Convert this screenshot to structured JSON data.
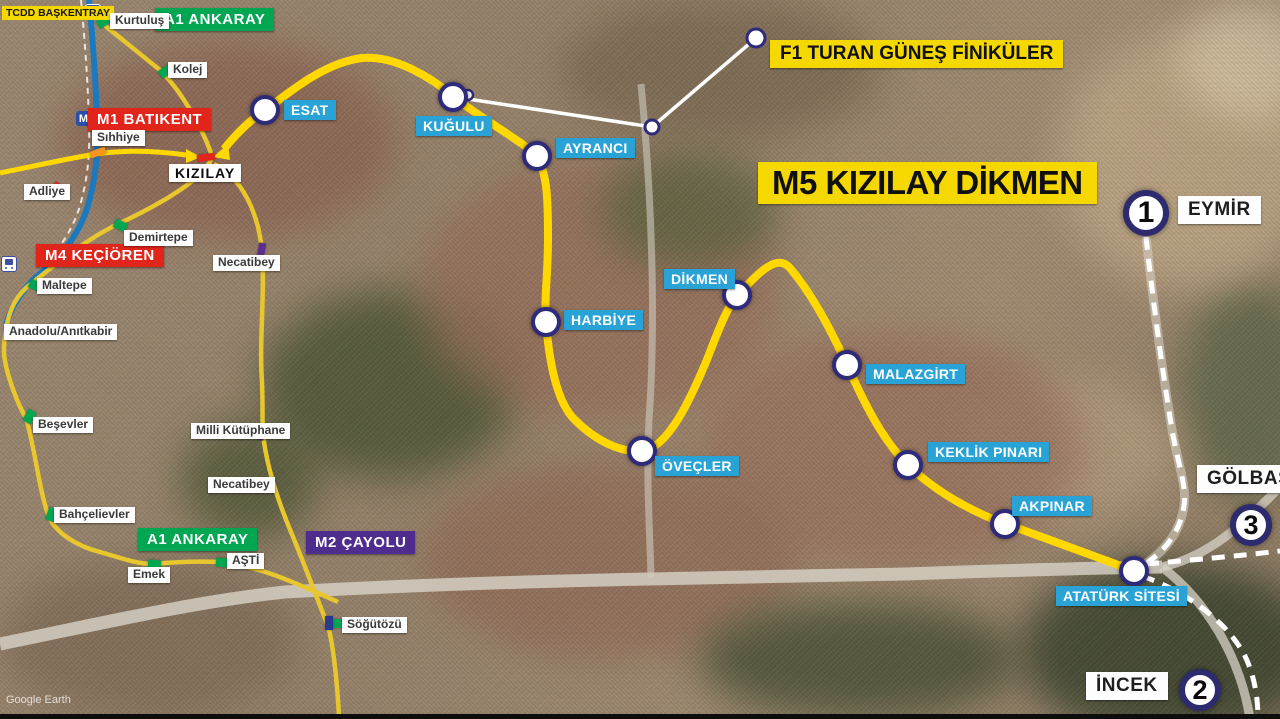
{
  "map": {
    "attribution": "Google Earth",
    "colors": {
      "m5_line": "#ffd800",
      "ankaray_m2_line": "#e8c62e",
      "m1_blue_line": "#1b79c0",
      "funicular_line": "#ffffff",
      "future_dashed_line": "#ffffff",
      "station_ring": "#2f2b7b",
      "station_label_bg": "#29a3d6",
      "title_bg": "#f5d800",
      "green_label_bg": "#00a651",
      "red_label_bg": "#e1251b",
      "purple_label_bg": "#4f2d8e"
    }
  },
  "title": {
    "text": "M5 KIZILAY DİKMEN"
  },
  "funicular_label": {
    "text": "F1 TURAN GÜNEŞ FİNİKÜLER"
  },
  "m5_stations": [
    {
      "id": "esat",
      "name": "ESAT",
      "cx": 265,
      "cy": 110,
      "lx": 284,
      "ly": 100
    },
    {
      "id": "kugulu",
      "name": "KUĞULU",
      "cx": 453,
      "cy": 97,
      "lx": 416,
      "ly": 116
    },
    {
      "id": "ayranci",
      "name": "AYRANCI",
      "cx": 537,
      "cy": 156,
      "lx": 556,
      "ly": 138
    },
    {
      "id": "harbiye",
      "name": "HARBİYE",
      "cx": 546,
      "cy": 322,
      "lx": 564,
      "ly": 310
    },
    {
      "id": "dikmen",
      "name": "DİKMEN",
      "cx": 737,
      "cy": 295,
      "lx": 664,
      "ly": 269
    },
    {
      "id": "ovecler",
      "name": "ÖVEÇLER",
      "cx": 642,
      "cy": 451,
      "lx": 655,
      "ly": 456
    },
    {
      "id": "malazgirt",
      "name": "MALAZGİRT",
      "cx": 847,
      "cy": 365,
      "lx": 866,
      "ly": 364
    },
    {
      "id": "keklik-pinari",
      "name": "KEKLİK PINARI",
      "cx": 908,
      "cy": 465,
      "lx": 928,
      "ly": 442
    },
    {
      "id": "akpinar",
      "name": "AKPINAR",
      "cx": 1005,
      "cy": 524,
      "lx": 1012,
      "ly": 496
    },
    {
      "id": "ataturk-sitesi",
      "name": "ATATÜRK SİTESİ",
      "cx": 1134,
      "cy": 571,
      "lx": 1056,
      "ly": 586
    }
  ],
  "route_labels": [
    {
      "id": "tcdd-baskentray",
      "text": "TCDD BAŞKENTRAY",
      "style": "yellow-sm",
      "x": 2,
      "y": 6
    },
    {
      "id": "a1-ankaray-north",
      "text": "A1 ANKARAY",
      "style": "green",
      "x": 155,
      "y": 8
    },
    {
      "id": "a1-ankaray-south",
      "text": "A1 ANKARAY",
      "style": "green",
      "x": 138,
      "y": 528
    },
    {
      "id": "m1-batikent",
      "text": "M1 BATIKENT",
      "style": "red",
      "x": 88,
      "y": 108
    },
    {
      "id": "m4-kecioren",
      "text": "M4 KEÇİÖREN",
      "style": "red",
      "x": 36,
      "y": 244
    },
    {
      "id": "m2-cayolu",
      "text": "M2 ÇAYOLU",
      "style": "purple",
      "x": 306,
      "y": 531
    }
  ],
  "minor_labels": [
    {
      "id": "kurtulus",
      "text": "Kurtuluş",
      "x": 110,
      "y": 13
    },
    {
      "id": "kolej",
      "text": "Kolej",
      "x": 168,
      "y": 62
    },
    {
      "id": "sihhiye",
      "text": "Sıhhiye",
      "x": 92,
      "y": 130
    },
    {
      "id": "kizilay",
      "text": "KIZILAY",
      "x": 169,
      "y": 164,
      "style": "kizilay"
    },
    {
      "id": "adliye",
      "text": "Adliye",
      "x": 24,
      "y": 184
    },
    {
      "id": "demirtepe",
      "text": "Demirtepe",
      "x": 124,
      "y": 230
    },
    {
      "id": "necatibey-north",
      "text": "Necatibey",
      "x": 213,
      "y": 255
    },
    {
      "id": "maltepe",
      "text": "Maltepe",
      "x": 37,
      "y": 278
    },
    {
      "id": "anadolu-anitkabir",
      "text": "Anadolu/Anıtkabir",
      "x": 4,
      "y": 324
    },
    {
      "id": "besevler",
      "text": "Beşevler",
      "x": 33,
      "y": 417
    },
    {
      "id": "milli-kutuphane",
      "text": "Milli Kütüphane",
      "x": 191,
      "y": 423
    },
    {
      "id": "necatibey-south",
      "text": "Necatibey",
      "x": 208,
      "y": 477
    },
    {
      "id": "bahcelievler",
      "text": "Bahçelievler",
      "x": 54,
      "y": 507
    },
    {
      "id": "asti",
      "text": "AŞTİ",
      "x": 227,
      "y": 553
    },
    {
      "id": "emek",
      "text": "Emek",
      "x": 128,
      "y": 567
    },
    {
      "id": "sogutozu",
      "text": "Söğütözü",
      "x": 342,
      "y": 617
    }
  ],
  "big_labels": [
    {
      "id": "eymir",
      "text": "EYMİR",
      "x": 1178,
      "y": 196
    },
    {
      "id": "golbasi",
      "text": "GÖLBAŞI",
      "x": 1197,
      "y": 465
    },
    {
      "id": "incek",
      "text": "İNCEK",
      "x": 1086,
      "y": 672
    }
  ],
  "numbered_markers": [
    {
      "n": "1",
      "x": 1146,
      "y": 213,
      "d": 46,
      "fs": 30
    },
    {
      "n": "2",
      "x": 1200,
      "y": 690,
      "d": 42,
      "fs": 27
    },
    {
      "n": "3",
      "x": 1251,
      "y": 525,
      "d": 42,
      "fs": 27
    }
  ],
  "line_markers": {
    "green": [
      {
        "x": 97,
        "y": 17,
        "r": -35
      },
      {
        "x": 159,
        "y": 67,
        "r": -35
      },
      {
        "x": 114,
        "y": 221,
        "r": 25
      },
      {
        "x": 29,
        "y": 281,
        "r": 25
      },
      {
        "x": 23,
        "y": 412,
        "r": -60
      },
      {
        "x": 45,
        "y": 510,
        "r": -70
      },
      {
        "x": 148,
        "y": 560,
        "r": 5
      },
      {
        "x": 216,
        "y": 558,
        "r": 5
      },
      {
        "x": 333,
        "y": 619,
        "r": 0
      }
    ],
    "purple": [
      {
        "x": 258,
        "y": 243,
        "r": 10
      },
      {
        "x": 258,
        "y": 426,
        "r": 15
      }
    ],
    "orange": [
      {
        "x": 90,
        "y": 149,
        "r": -20
      }
    ],
    "red": [
      {
        "x": 52,
        "y": 186,
        "r": 38
      },
      {
        "x": 197,
        "y": 154,
        "r": -8
      }
    ],
    "blue_sq": [
      {
        "x": 325,
        "y": 616
      }
    ]
  },
  "icons": [
    {
      "id": "train-icon-top",
      "style": "blue",
      "x": 85,
      "y": 4
    },
    {
      "id": "train-icon-left",
      "style": "white",
      "x": 1,
      "y": 256
    },
    {
      "id": "metro-m-icon",
      "style": "m",
      "x": 76,
      "y": 111
    }
  ]
}
